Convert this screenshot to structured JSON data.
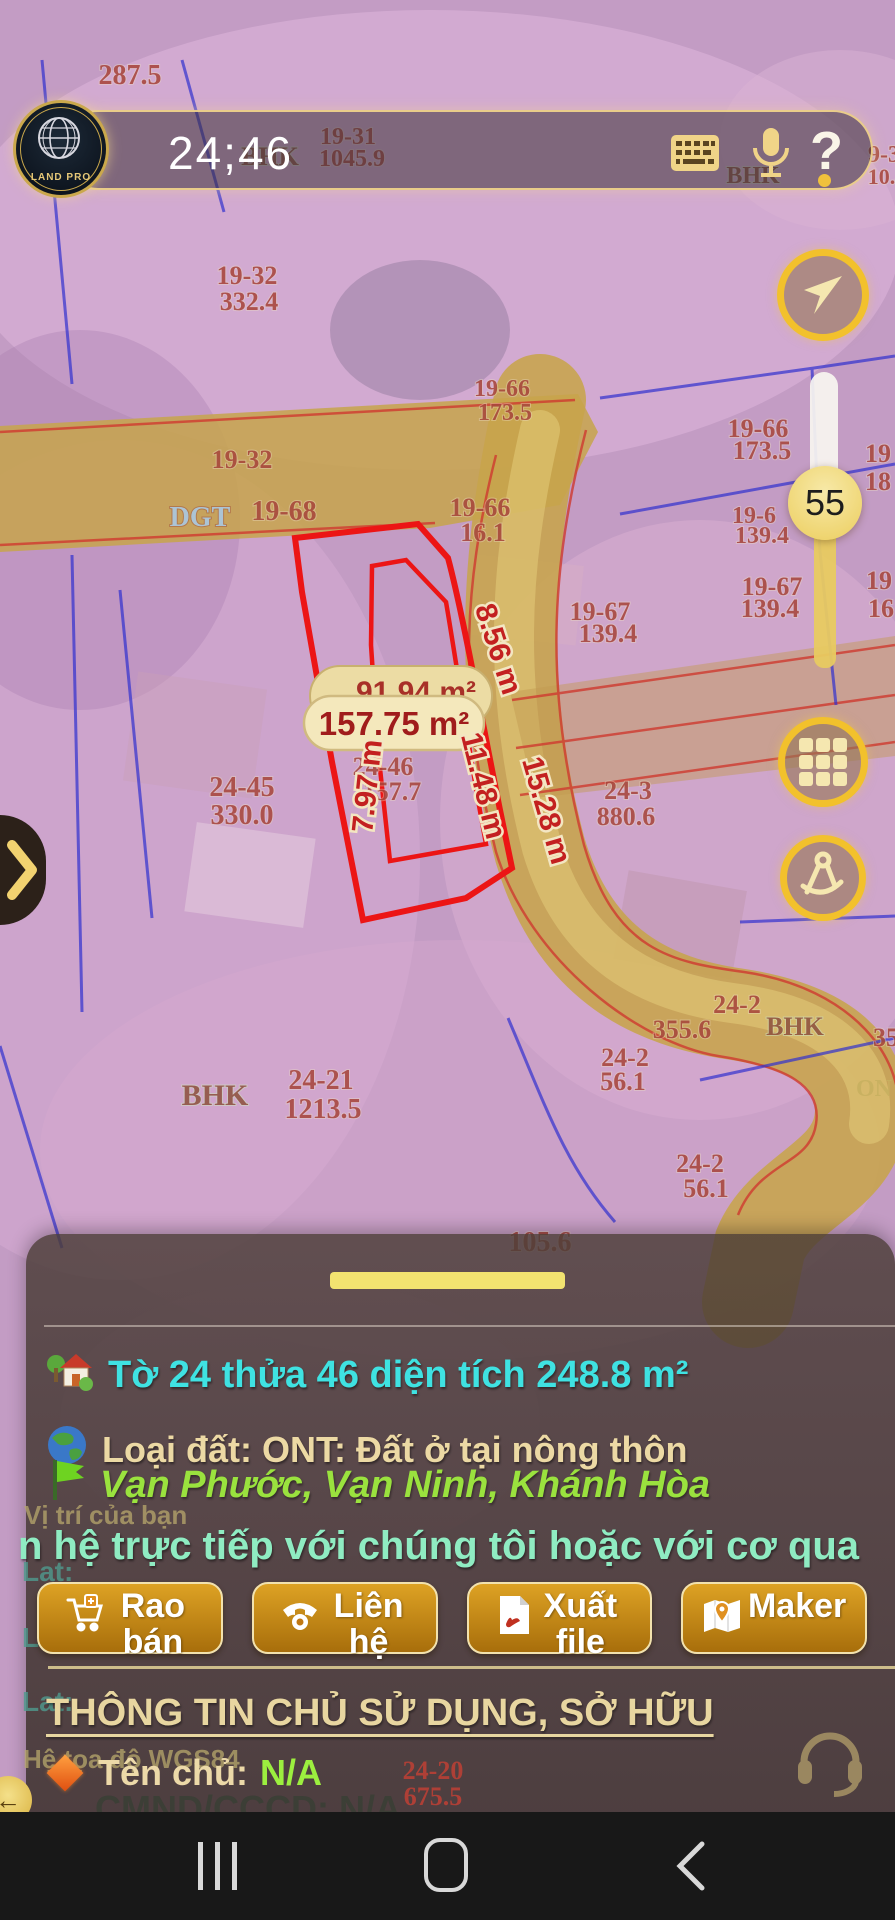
{
  "top_bar": {
    "timer": "24;46",
    "logo_brand": "LAND PRO",
    "help_label": "?"
  },
  "controls": {
    "zoom_value": "55"
  },
  "map": {
    "labels": [
      "287.5",
      "BHK",
      "19-31",
      "1045.9",
      "BHK",
      "9-3",
      "10.4",
      "19-32",
      "332.4",
      "19-32",
      "19-68",
      "DGT",
      "19-66",
      "16.1",
      "19-66",
      "173.5",
      "19-67",
      "139.4",
      "19-66",
      "173.5",
      "19-6",
      "139.4",
      "19-67",
      "139.4",
      "19",
      "18",
      "19",
      "16",
      "24-45",
      "330.0",
      "24-46",
      "157.7",
      "24-3",
      "880.6",
      "24-2",
      "355.6",
      "24-2",
      "56.1",
      "24-2",
      "56.1",
      "BHK",
      "35",
      "105.6",
      "BHK",
      "24-21",
      "1213.5",
      "24-20",
      "675.5",
      "ON"
    ],
    "measurements": {
      "a": "8.56 m",
      "b": "11.48 m",
      "c": "15.28 m",
      "d": "7.97 m"
    },
    "area_pills": {
      "front": "157.75 m²",
      "back": "91.94 m²"
    }
  },
  "sheet": {
    "title": "Tờ 24 thửa 46 diện tích 248.8 m²",
    "land_type": "Loại đất: ONT: Đất ở tại nông thôn",
    "address": "Vạn Phước, Vạn Ninh, Khánh Hòa",
    "marquee": "n hệ trực tiếp với chúng tôi hoặc với cơ qua",
    "buttons": [
      {
        "label": "Rao bán"
      },
      {
        "label": "Liên hệ"
      },
      {
        "label": "Xuất file"
      },
      {
        "label": "Maker"
      }
    ],
    "owner_heading": "THÔNG TIN CHỦ SỬ DỤNG, SỞ HỮU",
    "owner_label": "Tên chủ:",
    "owner_value": "N/A",
    "id_line": "CMND/CCCD: N/A"
  },
  "background_texts": {
    "your_location": "Vị trí của bạn",
    "lat": "Lat:",
    "lng": "Lng:",
    "lat2": "Lat:",
    "lng2": "Lng:",
    "coord_system": "Hệ tọa độ WGS84",
    "behind_label": "24-20",
    "behind_value": "675.5"
  },
  "colors": {
    "accent_gold": "#f2c12c",
    "cream": "#f5e7b0",
    "parcel_red": "#ec1515",
    "boundary_blue": "#3030cf",
    "title_cyan": "#3fe2e2",
    "address_green": "#9ae23e",
    "owner_na_green": "#9cef3f"
  }
}
